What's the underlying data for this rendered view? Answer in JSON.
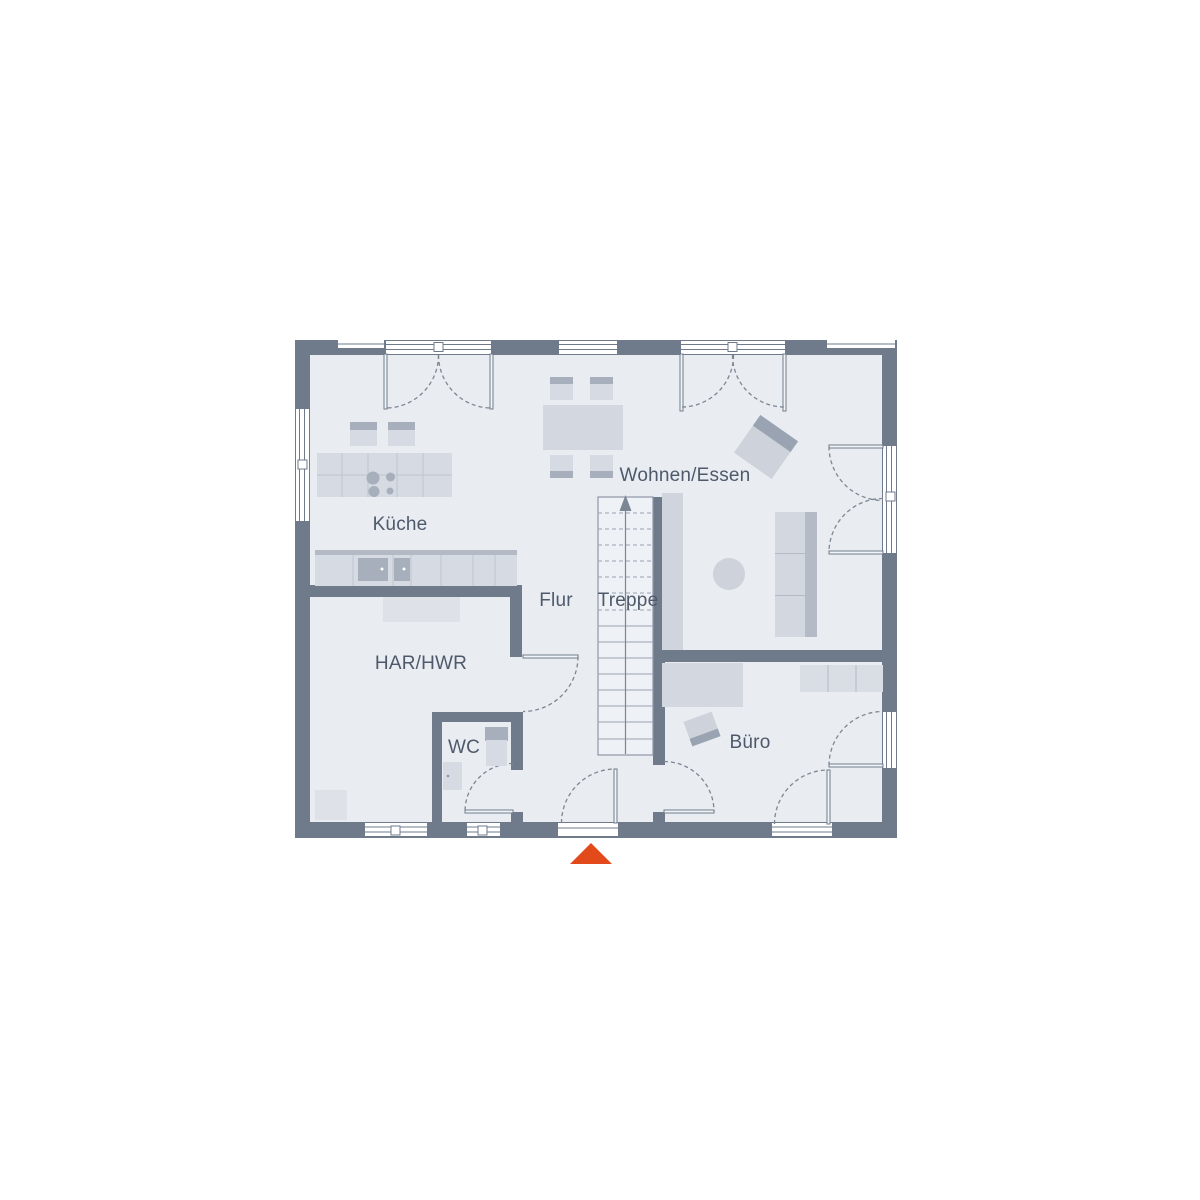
{
  "plan": {
    "type": "floor-plan",
    "rooms": [
      {
        "id": "kueche",
        "label": "Küche"
      },
      {
        "id": "wohnen_essen",
        "label": "Wohnen/Essen"
      },
      {
        "id": "flur",
        "label": "Flur"
      },
      {
        "id": "treppe",
        "label": "Treppe"
      },
      {
        "id": "har_hwr",
        "label": "HAR/HWR"
      },
      {
        "id": "wc",
        "label": "WC"
      },
      {
        "id": "buero",
        "label": "Büro"
      }
    ],
    "colors": {
      "background": "#ffffff",
      "wall": "#6f7b8b",
      "floor": "#e9ecf1",
      "stair_floor": "#eef1f5",
      "furniture_light": "#d6dae2",
      "furniture_mid": "#cdd2db",
      "furniture_accent": "#a7afbc",
      "detail_line": "#8d97a6",
      "label_text": "#4e5a6b",
      "entrance_marker": "#e2491b"
    }
  }
}
